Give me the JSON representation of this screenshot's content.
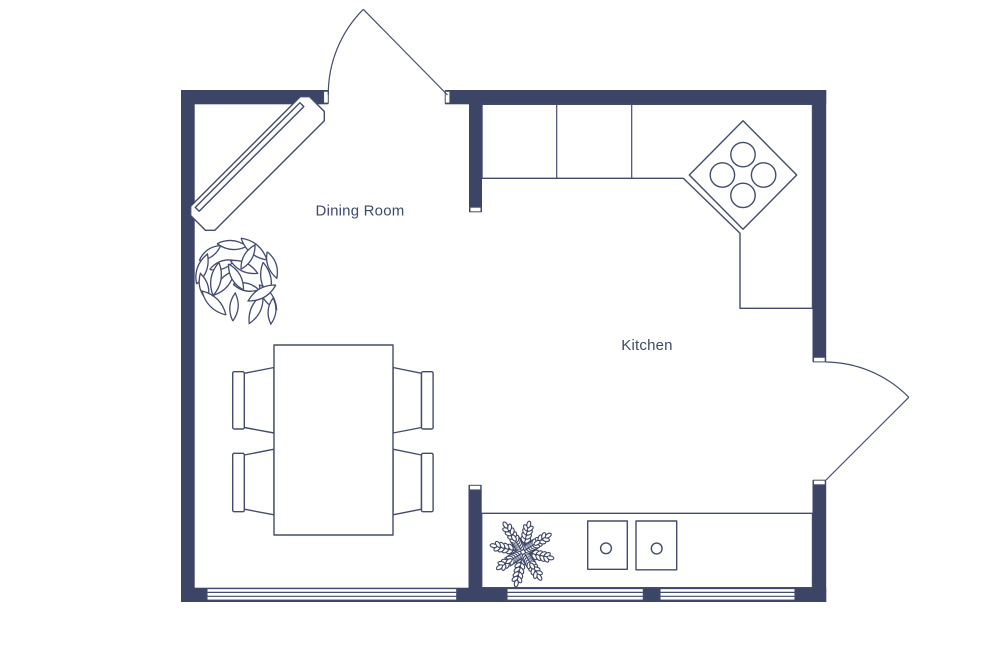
{
  "floor_plan": {
    "background_color": "#ffffff",
    "wall_color": "#3d4566",
    "line_color": "#434c6e",
    "label_color": "#3e4a6c",
    "rooms": [
      {
        "id": "dining-room",
        "label": "Dining Room"
      },
      {
        "id": "kitchen",
        "label": "Kitchen"
      }
    ],
    "fixtures": {
      "doors": 2,
      "windows": 3,
      "dining_chairs": 4,
      "dining_tables": 1,
      "stove_burners": 4,
      "sink_basins": 2,
      "plants": 2,
      "sideboards": 1
    }
  }
}
